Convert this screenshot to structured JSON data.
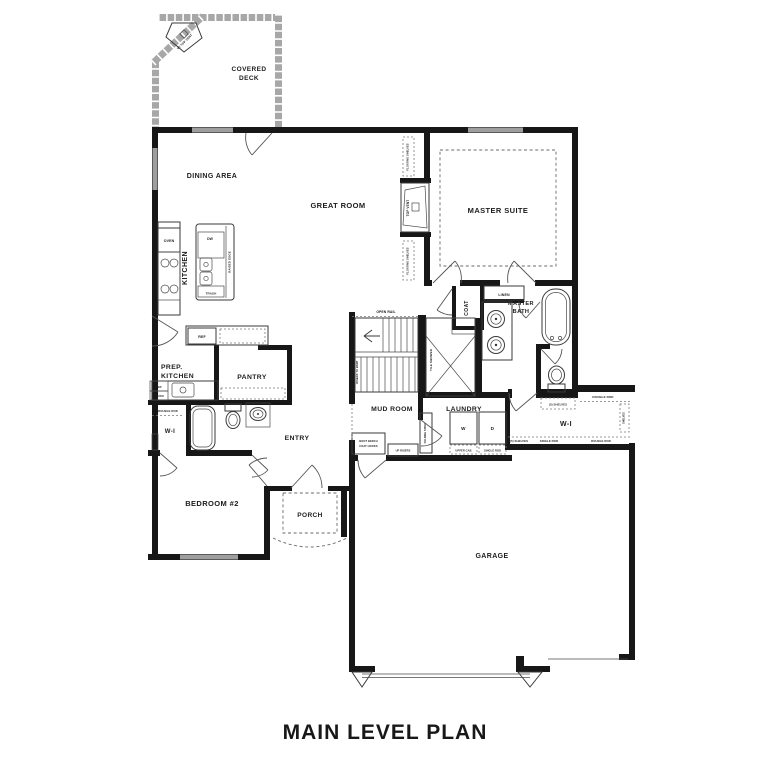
{
  "title": "MAIN LEVEL PLAN",
  "rooms": {
    "covered_deck_line1": "COVERED",
    "covered_deck_line2": "DECK",
    "dining_area": "DINING AREA",
    "great_room": "GREAT ROOM",
    "kitchen": "KITCHEN",
    "prep_kitchen_line1": "PREP.",
    "prep_kitchen_line2": "KITCHEN",
    "pantry": "PANTRY",
    "master_suite": "MASTER SUITE",
    "master_bath_line1": "MASTER",
    "master_bath_line2": "BATH",
    "coat": "COAT",
    "mud_room": "MUD ROOM",
    "laundry": "LAUNDRY",
    "walk_in_closet": "W-I",
    "bedroom2": "BEDROOM #2",
    "entry": "ENTRY",
    "porch": "PORCH",
    "garage": "GARAGE"
  },
  "fixtures": {
    "oven": "OVEN",
    "dishwasher": "DW",
    "trash": "TRASH",
    "raised_edge": "RAISED EDGE",
    "refrigerator": "REF",
    "microwave": "MICRO",
    "open_rail": "OPEN RAIL",
    "stair_risers": "RISERS TO BSMT",
    "shelf": "SHELF",
    "tile_shower": "TILE SHOWER",
    "linen": "LINEN",
    "top_vent": "TOP VENT",
    "deck_fireplace": "W/ TOP VENT",
    "floating_shelves": "FLOATING SHELVES",
    "boot_bench_line1": "BOOT BENCH",
    "boot_bench_line2": "COAT HOOKS",
    "up_risers": "UP RISERS",
    "folding_table": "FOLDING TABLE",
    "washer": "W",
    "dryer": "D",
    "upper_cab": "UPPER CAB",
    "single_rod": "SINGLE ROD",
    "double_rod": "DOUBLE ROD",
    "five_shelves": "(5) SHELVES",
    "shelves": "SHELVES"
  }
}
